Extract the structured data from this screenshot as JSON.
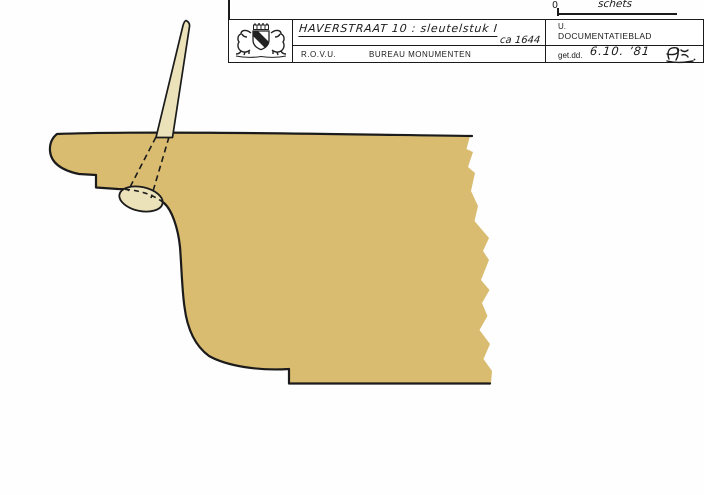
{
  "colors": {
    "ink": "#1b1b1b",
    "wood": "#d9bc70",
    "peg": "#ece2ba",
    "paper": "#ffffff"
  },
  "scale_note": {
    "zero": "0",
    "label": "schets"
  },
  "title_block": {
    "arms_icon": "utrecht-coat-of-arms-stamp",
    "project": "HAVERSTRAAT 10 :  sleutelstuk I",
    "circa": "ca 1644",
    "org_abbr": "R.O.V.U.",
    "org_name": "BUREAU  MONUMENTEN",
    "doc_line1": "U.",
    "doc_line2": "DOCUMENTATIEBLAD",
    "date_label": "get.dd.",
    "date_value": "6.10. ’81",
    "signature_initials": "Pk."
  }
}
